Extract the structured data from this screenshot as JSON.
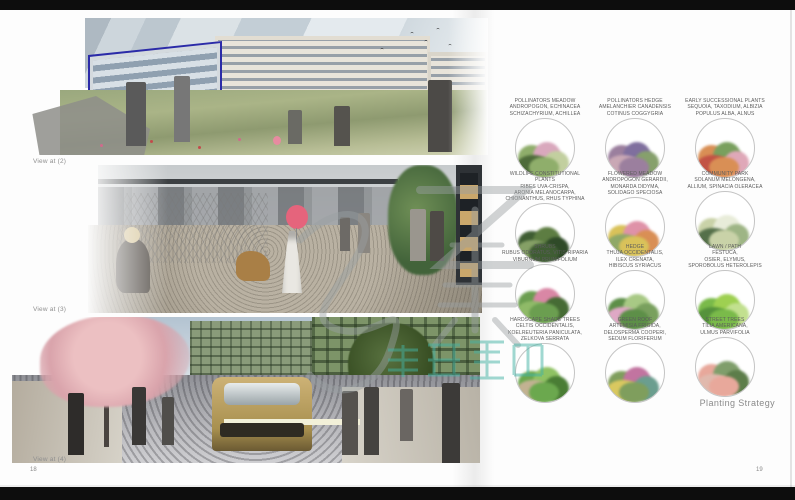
{
  "left_page": {
    "views": [
      {
        "label": "View at (2)"
      },
      {
        "label": "View at (3)"
      },
      {
        "label": "View at (4)"
      }
    ],
    "page_number": "18"
  },
  "right_page": {
    "caption": "Planting Strategy",
    "page_number": "19",
    "palette": [
      {
        "lines": [
          "POLLINATORS MEADOW",
          "ANDROPOGON, ECHINACEA",
          "SCHIZACHYRIUM, ACHILLEA"
        ],
        "colors": [
          "#8fae6b",
          "#d9a8bd",
          "#4e6b3a",
          "#c2cf9f"
        ]
      },
      {
        "lines": [
          "POLLINATORS HEDGE",
          "AMELANCHIER CANADENSIS",
          "COTINUS COGGYGRIA"
        ],
        "colors": [
          "#9b7f9e",
          "#7f6f9e",
          "#c9a8b5",
          "#86a06c"
        ]
      },
      {
        "lines": [
          "EARLY SUCCESSIONAL PLANTS",
          "SEQUOIA, TAXODIUM, ALBIZIA",
          "POPULUS ALBA, ALNUS"
        ],
        "colors": [
          "#d98f55",
          "#79a05e",
          "#c25345",
          "#dfa8b8"
        ]
      },
      {
        "lines": [
          "WILDLIFE CONSTITUTIONAL PLANTS",
          "RIBES UVA-CRISPA,",
          "ARONIA MELANOCARPA,",
          "CHIONANTHUS, RHUS TYPHINA"
        ],
        "colors": [
          "#3f5d33",
          "#5d7d42",
          "#85a066",
          "#2f4a28"
        ]
      },
      {
        "lines": [
          "FLOWERED MEADOW",
          "ANDROPOGON GERARDII,",
          "MONARDA DIDYMA,",
          "SOLIDAGO SPECIOSA"
        ],
        "colors": [
          "#d9c25a",
          "#df92a8",
          "#8fa868",
          "#d98f55"
        ]
      },
      {
        "lines": [
          "COMMUNITY PARK",
          "SOLANUM MELONGENA,",
          "ALLIUM, SPINACIA OLERACEA"
        ],
        "colors": [
          "#c9d2a8",
          "#e8ecd9",
          "#55704a",
          "#9eb585"
        ]
      },
      {
        "lines": [
          "SHRUBS",
          "RUBUS ODORATUS, VITIS RIPARIA",
          "VIBURNUM PRUNIFOLIUM"
        ],
        "colors": [
          "#6b9e50",
          "#d987a5",
          "#8fba68",
          "#466b35"
        ]
      },
      {
        "lines": [
          "HEDGE",
          "THUJA OCCIDENTALIS,",
          "ILEX CRENATA,",
          "HIBISCUS SYRIACUS"
        ],
        "colors": [
          "#5d8f48",
          "#a8c985",
          "#dfa8c5",
          "#79a05e"
        ]
      },
      {
        "lines": [
          "LAWN / PATH",
          "FESTUCA,",
          "OSIER, ELYMUS,",
          "SPOROBOLUS HETEROLEPIS"
        ],
        "colors": [
          "#7aba4a",
          "#9ed051",
          "#55923c",
          "#c2e08f"
        ]
      },
      {
        "lines": [
          "HARDSCAPE SHADE TREES",
          "CELTIS OCCIDENTALIS,",
          "KOELREUTERIA PANICULATA,",
          "ZELKOVA SERRATA"
        ],
        "colors": [
          "#6ba84e",
          "#8fc263",
          "#c2b292",
          "#4a7d35"
        ]
      },
      {
        "lines": [
          "GREEN ROOF",
          "ARTEMISIA FRIGIDA,",
          "DELOSPERMA COOPERI,",
          "SEDUM FLORIFERUM"
        ],
        "colors": [
          "#7f9e5d",
          "#c274a0",
          "#d9c860",
          "#6b9e8f"
        ]
      },
      {
        "lines": [
          "STREET TREES",
          "TILIA AMERICANA,",
          "ULMUS PARVIFOLIA"
        ],
        "colors": [
          "#e8a89b",
          "#7f9e6b",
          "#e0b9ad",
          "#5d7d4a"
        ]
      }
    ]
  },
  "watermark": {
    "characters": "集",
    "overlay_text": "作品集辅导",
    "gray_color": "#9aa0a2",
    "teal_color": "#44b3a4"
  }
}
